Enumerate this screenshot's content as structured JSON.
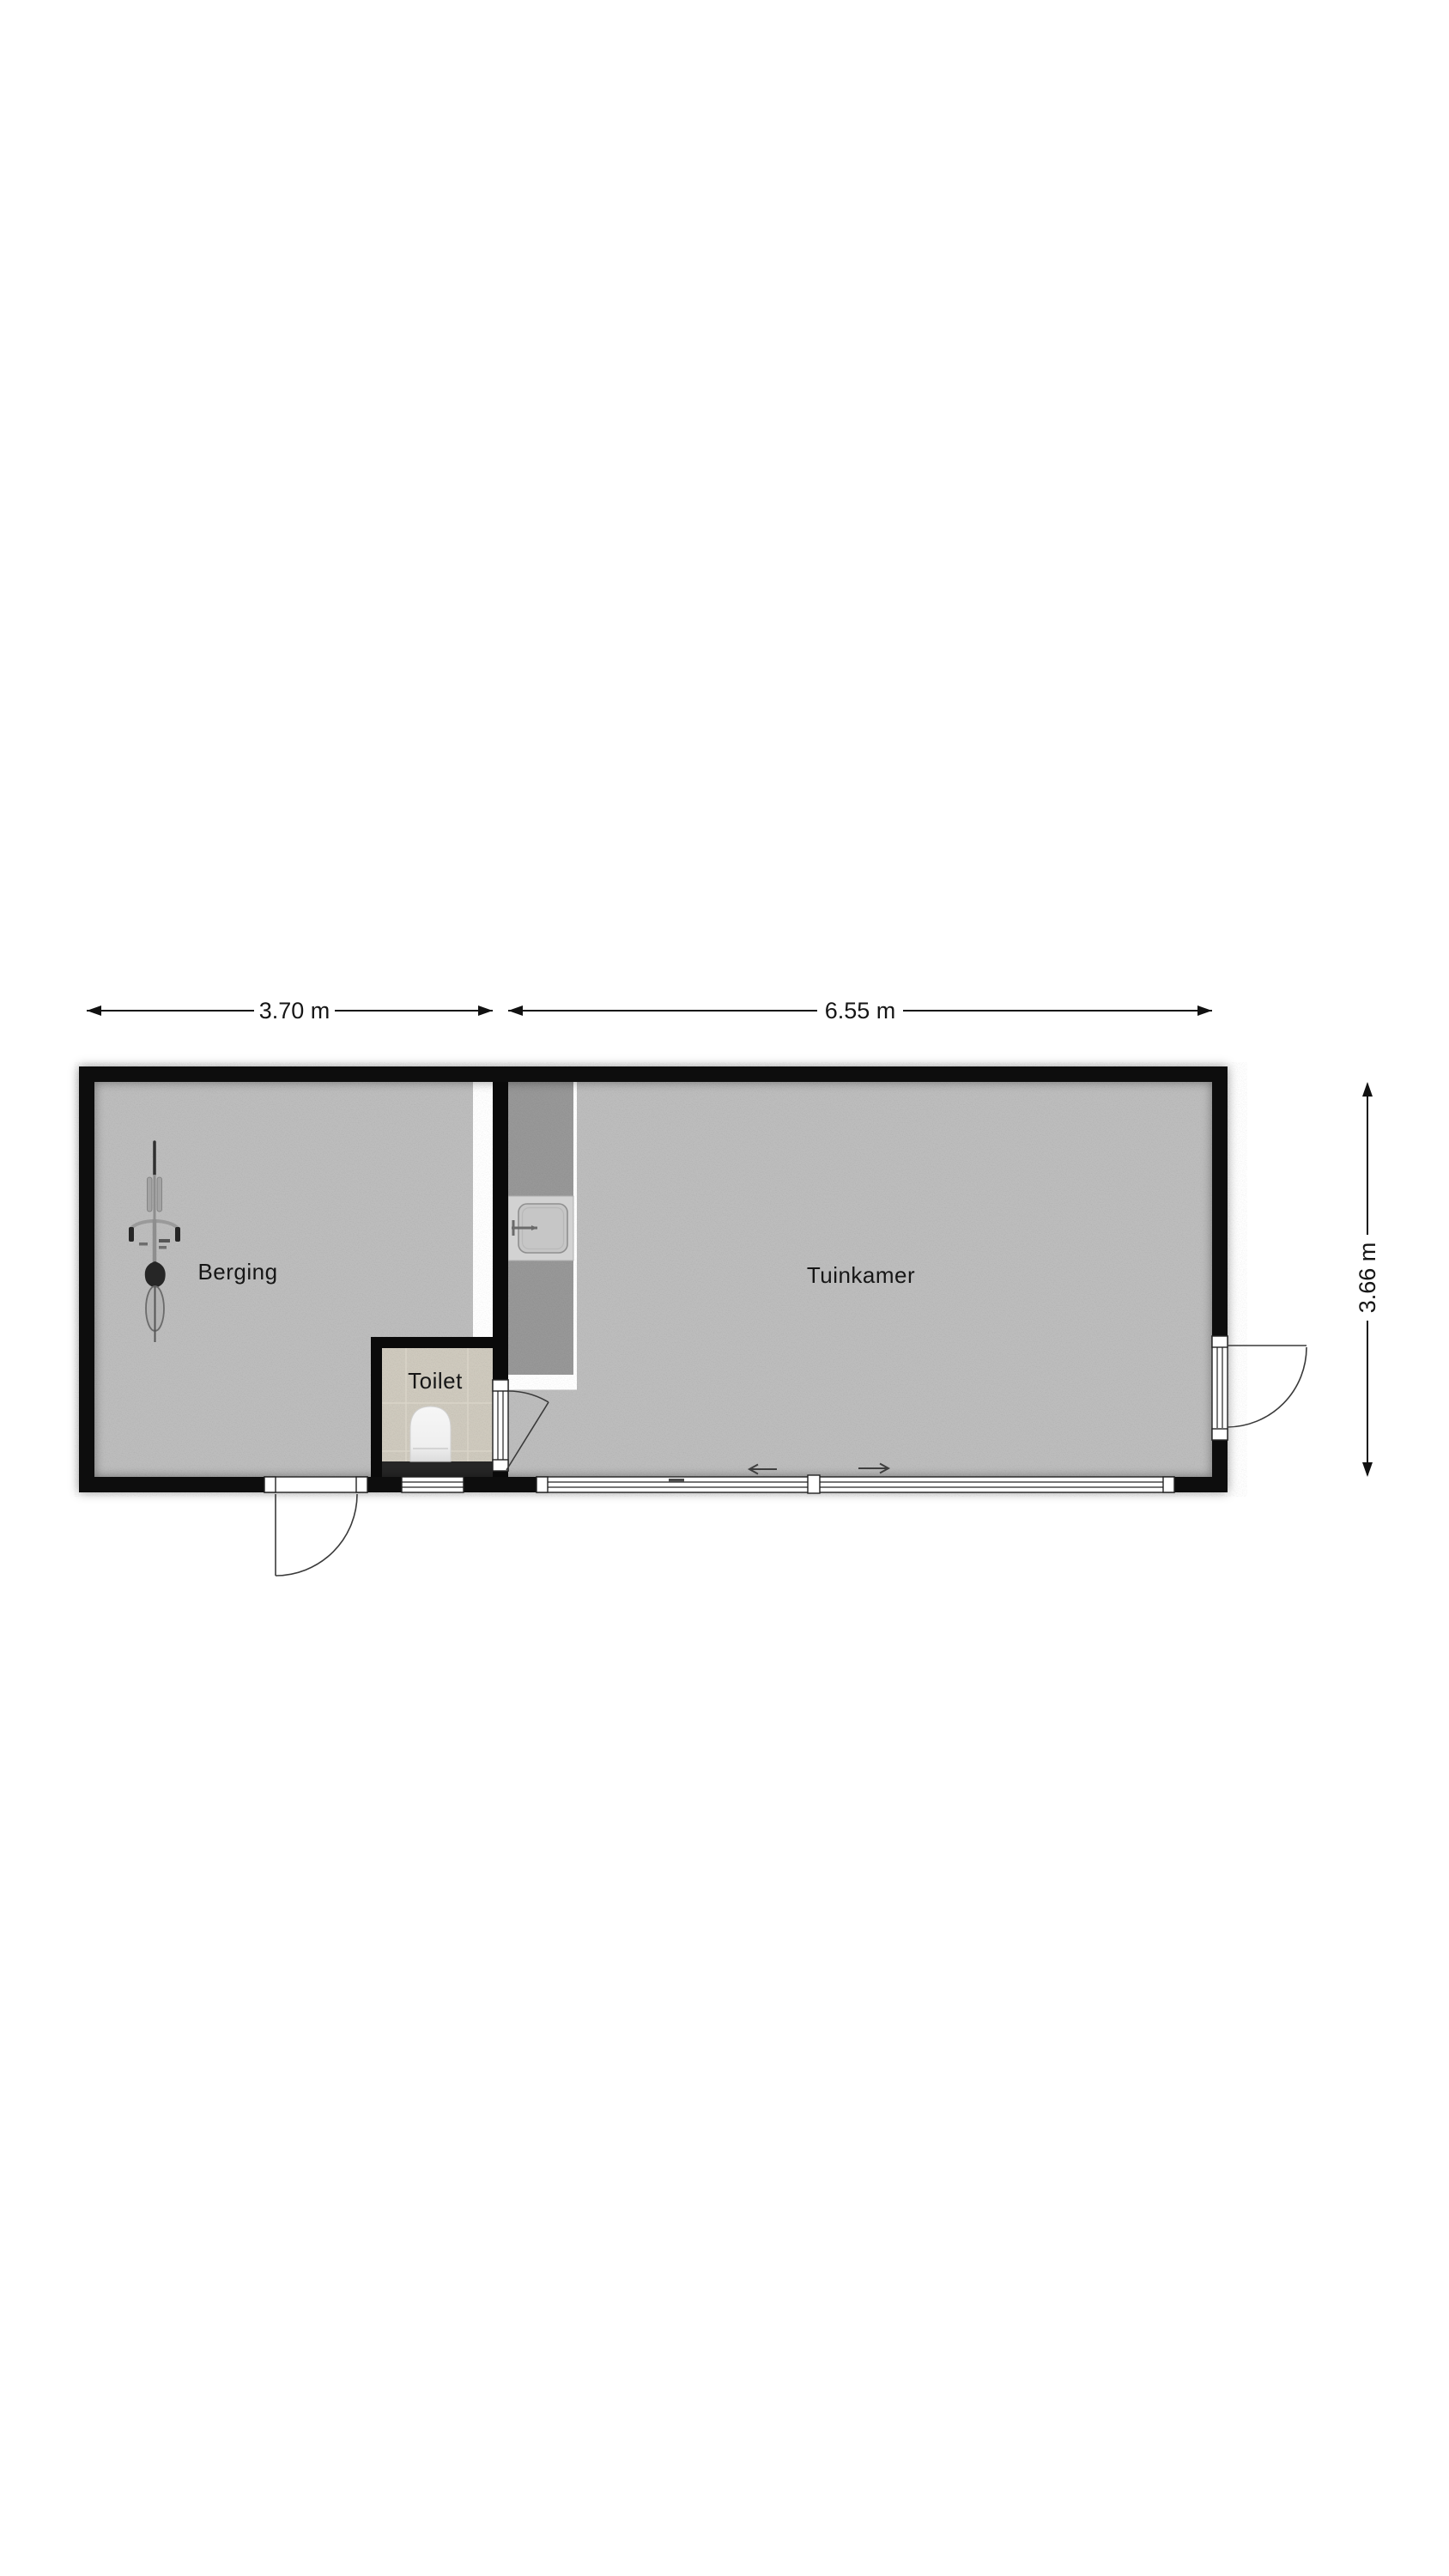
{
  "floorplan": {
    "dimension_labels": {
      "berging_width": "3.70 m",
      "tuinkamer_width": "6.55 m",
      "depth": "3.66 m"
    },
    "room_labels": {
      "berging": "Berging",
      "toilet": "Toilet",
      "tuinkamer": "Tuinkamer"
    },
    "colors": {
      "background": "#ffffff",
      "wall": "#0a0a0a",
      "floor": "#b5b5b5",
      "counter": "#8f8f8f",
      "toilet_tile": "#c4bfb3",
      "toilet_plinth": "#262626",
      "fixture_white": "#f2f2f2",
      "frame_stroke": "#222222",
      "dimension_stroke": "#111111"
    },
    "fixtures": [
      "bicycle-icon",
      "kitchen-sink-icon",
      "toilet-icon",
      "door-swing-icon",
      "sliding-door-icon"
    ]
  }
}
